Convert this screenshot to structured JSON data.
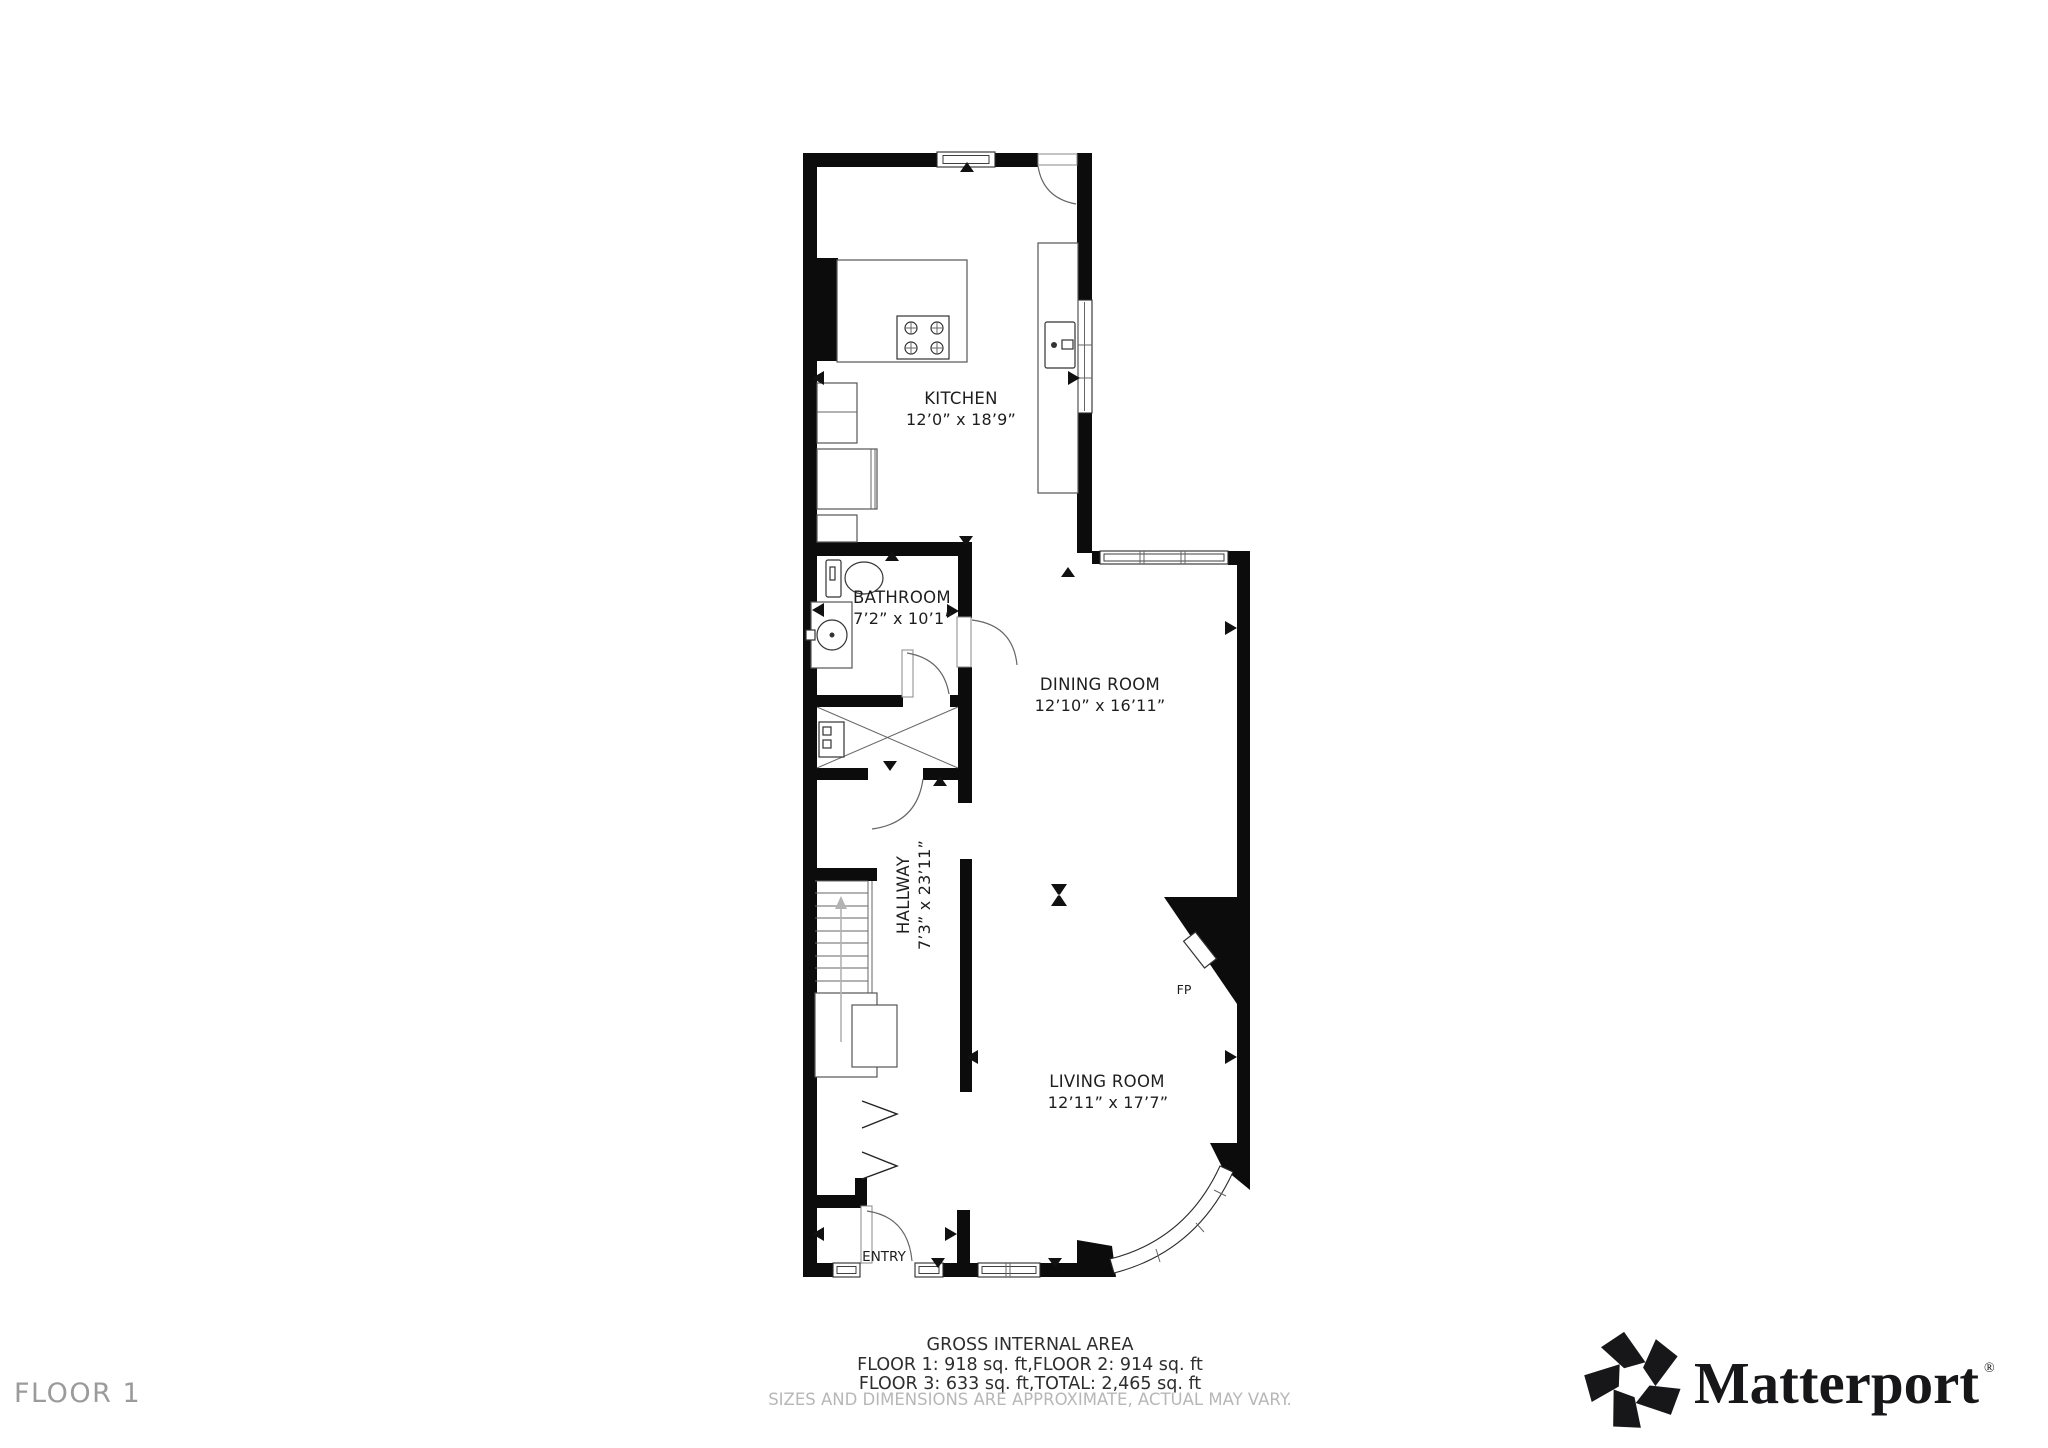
{
  "floor_label": "FLOOR 1",
  "rooms": {
    "kitchen": {
      "name": "KITCHEN",
      "dims": "12’0” x 18’9”"
    },
    "bathroom": {
      "name": "BATHROOM",
      "dims": "7’2” x 10’1”"
    },
    "dining": {
      "name": "DINING ROOM",
      "dims": "12’10” x 16’11”"
    },
    "hallway": {
      "name": "HALLWAY",
      "dims": "7’3” x 23’11”"
    },
    "living": {
      "name": "LIVING ROOM",
      "dims": "12’11” x 17’7”"
    },
    "entry": {
      "name": "ENTRY"
    }
  },
  "labels": {
    "fireplace": "FP"
  },
  "footer": {
    "title": "GROSS INTERNAL AREA",
    "areas_line_1": "FLOOR 1: 918 sq. ft,FLOOR 2: 914 sq. ft",
    "areas_line_2": "FLOOR 3: 633 sq. ft,TOTAL: 2,465 sq. ft",
    "disclaimer": "SIZES AND DIMENSIONS ARE APPROXIMATE, ACTUAL MAY VARY."
  },
  "brand": {
    "name": "Matterport",
    "registered_mark": "®"
  },
  "colors": {
    "walls": "#0c0c0c",
    "room_labels": "#1e1e1e",
    "floor_label": "#9b9b9b",
    "disclaimer": "#b7b7b7",
    "logo": "#17171a"
  }
}
